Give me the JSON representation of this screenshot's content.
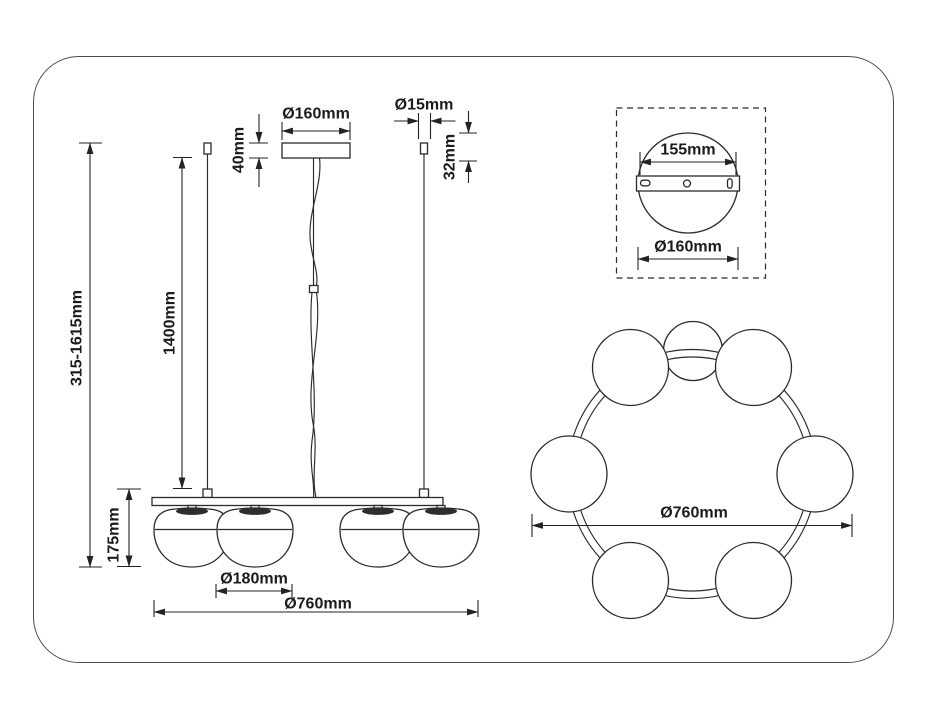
{
  "colors": {
    "line": "#2b2b2b",
    "dimension_line": "#232323",
    "text": "#1b1b1b",
    "background": "#ffffff",
    "frame_border": "#4c4c4c"
  },
  "views": {
    "front": {
      "name": "front elevation of pendant chandelier",
      "dimensions": {
        "canopy_diameter": "Ø160mm",
        "canopy_height": "40mm",
        "rod_diameter": "Ø15mm",
        "rod_mount_height": "32mm",
        "overall_height": "315-1615mm",
        "suspension_length": "1400mm",
        "body_height": "175mm",
        "shade_diameter": "Ø180mm",
        "overall_diameter": "Ø760mm"
      }
    },
    "canopy_detail": {
      "name": "ceiling canopy mounting plate detail",
      "dimensions": {
        "bracket_length": "155mm",
        "canopy_diameter": "Ø160mm"
      }
    },
    "top": {
      "name": "plan view of shade ring",
      "dimensions": {
        "overall_diameter": "Ø760mm"
      }
    }
  }
}
